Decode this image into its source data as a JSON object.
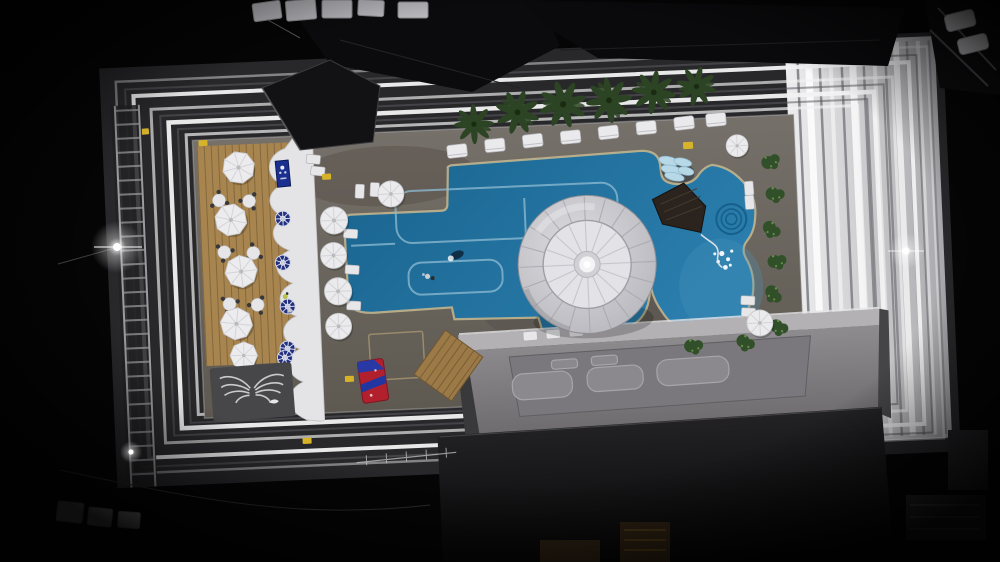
{
  "meta": {
    "scene": "aerial-night-view-of-hotel-rooftop-pool-deck",
    "camera": "top-down drone, night, slight counter-clockwise tilt",
    "lighting": "floodlit white terraced steps framing a dark rooftop"
  },
  "palette": {
    "night_black": "#050505",
    "terrace_ground": "#28282b",
    "terrace_line_white": "#f2f2f3",
    "terrace_shadow": "#5c5c60",
    "right_slab_light": "#ededef",
    "right_slab_dark": "#a9a9ad",
    "right_slab_stripe": "#898a8e",
    "deck_concrete": "#757069",
    "deck_concrete_dark": "#5e5951",
    "wood_deck": "#a8854f",
    "wood_plank_line": "#7c6138",
    "wood_platform": "#9b7a47",
    "scallop_white": "#e4e4e7",
    "pool_blue": "#1a648f",
    "pool_blue_light": "#2a7dac",
    "lagoon_glow": "#4b97bf",
    "lane_line": "#8fbcd3",
    "coping_tan": "#c9b88e",
    "dome_outer": "#c9c9ce",
    "dome_inner": "#e3e3e7",
    "dome_seam": "#a7a7ad",
    "dome_hub": "#f4f4f6",
    "palm_green": "#2c4423",
    "palm_core": "#1a2b12",
    "bush_green": "#31502a",
    "bush_highlight": "#6a8d4e",
    "furniture_white": "#eaeaed",
    "chair_dark": "#38383b",
    "table_blue": "#22307e",
    "bridge_brown": "#2b241e",
    "rock_aqua": "#b7d8e6",
    "building_gray": "#8e8c8f",
    "building_recess": "#7a787c",
    "skylight_gray": "#8b898d",
    "roof_dark": "#232225",
    "mat_gray": "#474649",
    "wings_white": "#d9d9dd",
    "towel_red": "#b2202e",
    "towel_blue": "#2839a6",
    "marker_yellow": "#d7b32a",
    "sign_blue": "#1b2f8f",
    "flare_white": "#ffffff",
    "scaffold_gray": "#9a9aa0"
  },
  "objects": {
    "pool": {
      "label": "freeform swimming pool with lagoon lobe",
      "swimmers": 2,
      "spa_rings": 3,
      "float_cluster_dots": 7
    },
    "dome_canopy": {
      "label": "large two-tier white canopy umbrella over pool edge",
      "tiers": 2
    },
    "palm_trees": {
      "count": 6,
      "location": "row along top edge of pool"
    },
    "daybeds_top_row": {
      "count": 8
    },
    "wood_deck_umbrellas": {
      "count": 5,
      "shape": "octagonal white"
    },
    "poolside_umbrellas": {
      "count": 6,
      "shape": "round white"
    },
    "dining_tables": {
      "count": 6
    },
    "blue_parasol_tables": {
      "count": 5
    },
    "planter_bushes": {
      "count": 8
    },
    "skylight_panels": {
      "count": 5
    },
    "ac_units_top": {
      "count": 5
    },
    "ac_units_bottom": {
      "count": 3
    },
    "floodlight_flares": {
      "count": 3
    },
    "yellow_step_markers": {
      "count": 6
    },
    "wings_mural": {
      "label": "white angel-wings art on dark mat"
    },
    "red_blue_towels": {
      "label": "folded red and blue towels on deck"
    },
    "bridge": {
      "label": "dark wooden walkway across pool neck"
    }
  }
}
